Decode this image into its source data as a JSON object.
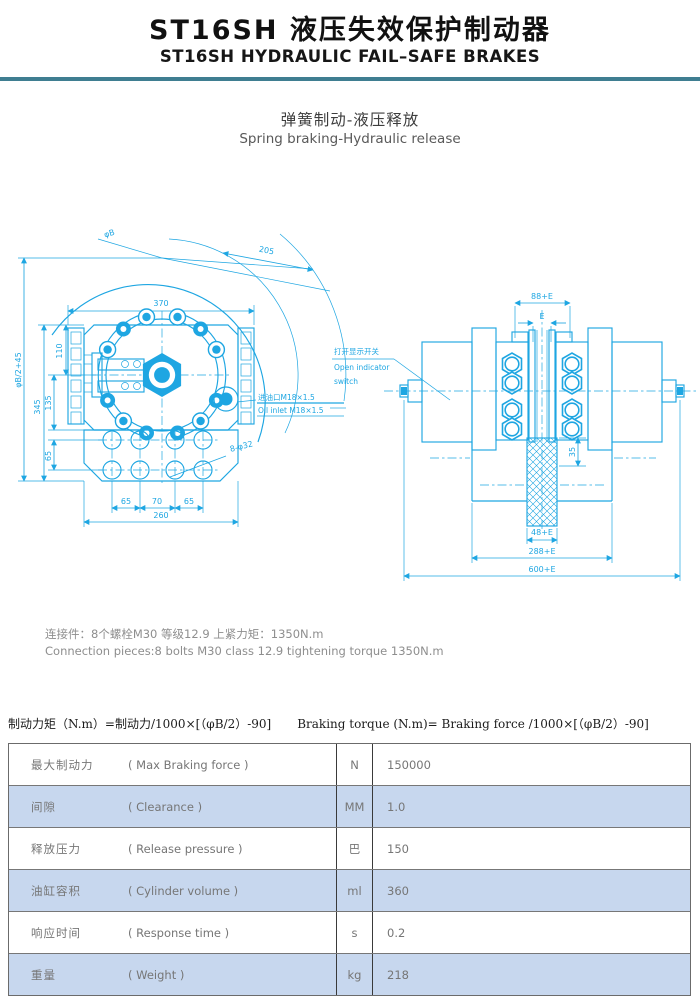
{
  "header": {
    "title_zh": "ST16SH 液压失效保护制动器",
    "title_en": "ST16SH HYDRAULIC FAIL–SAFE BRAKES",
    "subtitle_zh": "弹簧制动-液压释放",
    "subtitle_en": "Spring braking-Hydraulic release"
  },
  "colors": {
    "accent_bar": "#3f7e91",
    "drawing_line": "#1ea6e2",
    "table_alt_row": "#c7d7ee"
  },
  "front_view": {
    "dim_phi_b": "φB",
    "dim_205": "205",
    "dim_370": "370",
    "dim_phi_b2": "φB/2+45",
    "dim_345": "345",
    "dim_110": "110",
    "dim_135": "135",
    "dim_65_vertical": "65",
    "dim_65_left": "65",
    "dim_70": "70",
    "dim_65_right": "65",
    "dim_260": "260",
    "dim_holes": "8-φ32",
    "oil_inlet_zh": "进油口M18×1.5",
    "oil_inlet_en": "Oil inlet M18×1.5"
  },
  "side_view": {
    "dim_88e": "88+E",
    "dim_e": "E",
    "dim_35": "35",
    "dim_48e": "48+E",
    "dim_288e": "288+E",
    "dim_600e": "600+E",
    "switch_zh": "打开显示开关",
    "switch_en_line1": "Open indicator",
    "switch_en_line2": "switch"
  },
  "notes": {
    "connection_zh": "连接件：8个螺栓M30 等级12.9 上紧力矩：1350N.m",
    "connection_en": "Connection pieces:8 bolts M30 class 12.9 tightening torque 1350N.m"
  },
  "formula": {
    "zh": "制动力矩（N.m）=制动力/1000×[（φB/2）-90]",
    "en": "Braking torque (N.m)= Braking force /1000×[（φB/2）-90]"
  },
  "spec_table": {
    "rows": [
      {
        "label_zh": "最大制动力",
        "label_en": "( Max Braking force )",
        "unit": "N",
        "value": "150000"
      },
      {
        "label_zh": "间隙",
        "label_en": "( Clearance )",
        "unit": "MM",
        "value": "1.0"
      },
      {
        "label_zh": "释放压力",
        "label_en": "( Release pressure )",
        "unit": "巴",
        "value": "150"
      },
      {
        "label_zh": "油缸容积",
        "label_en": "( Cylinder volume )",
        "unit": "ml",
        "value": "360"
      },
      {
        "label_zh": "响应时间",
        "label_en": "( Response time )",
        "unit": "s",
        "value": "0.2"
      },
      {
        "label_zh": "重量",
        "label_en": "( Weight )",
        "unit": "kg",
        "value": "218"
      }
    ]
  }
}
